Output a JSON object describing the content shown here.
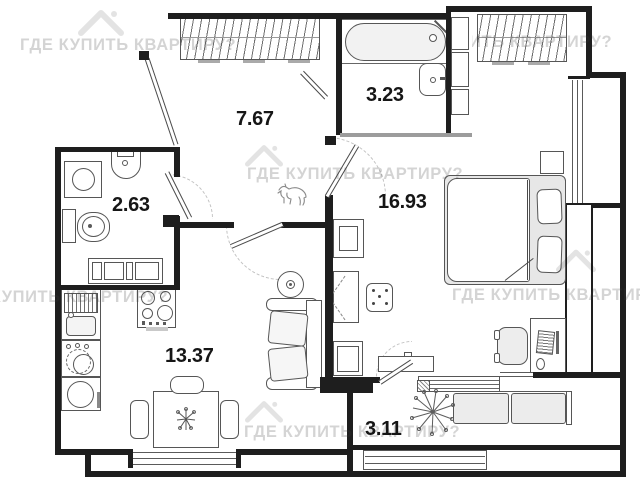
{
  "plan": {
    "title": "apartment floor plan",
    "watermark": "ГДЕ КУПИТЬ КВАРТИРУ?",
    "rooms": [
      {
        "key": "hallway",
        "area": "7.67",
        "furniture": [
          "wardrobe",
          "entry-door",
          "dog-sketch"
        ]
      },
      {
        "key": "bathroom",
        "area": "3.23",
        "furniture": [
          "bathtub",
          "sink",
          "shelving"
        ]
      },
      {
        "key": "toilet",
        "area": "2.63",
        "furniture": [
          "washing-machine",
          "sink",
          "toilet",
          "cabinet"
        ]
      },
      {
        "key": "bedroom",
        "area": "16.93",
        "furniture": [
          "wardrobe",
          "double-bed",
          "nightstand",
          "desk",
          "office-chair",
          "computer",
          "tv-unit",
          "pouf",
          "tv-stand"
        ]
      },
      {
        "key": "kitchen-living",
        "area": "13.37",
        "furniture": [
          "kitchen-sink",
          "stove",
          "dishwasher",
          "fridge",
          "dining-table",
          "chairs",
          "sofa",
          "coffee-table"
        ]
      },
      {
        "key": "balcony",
        "area": "3.11",
        "furniture": [
          "bench",
          "plant"
        ]
      }
    ]
  }
}
